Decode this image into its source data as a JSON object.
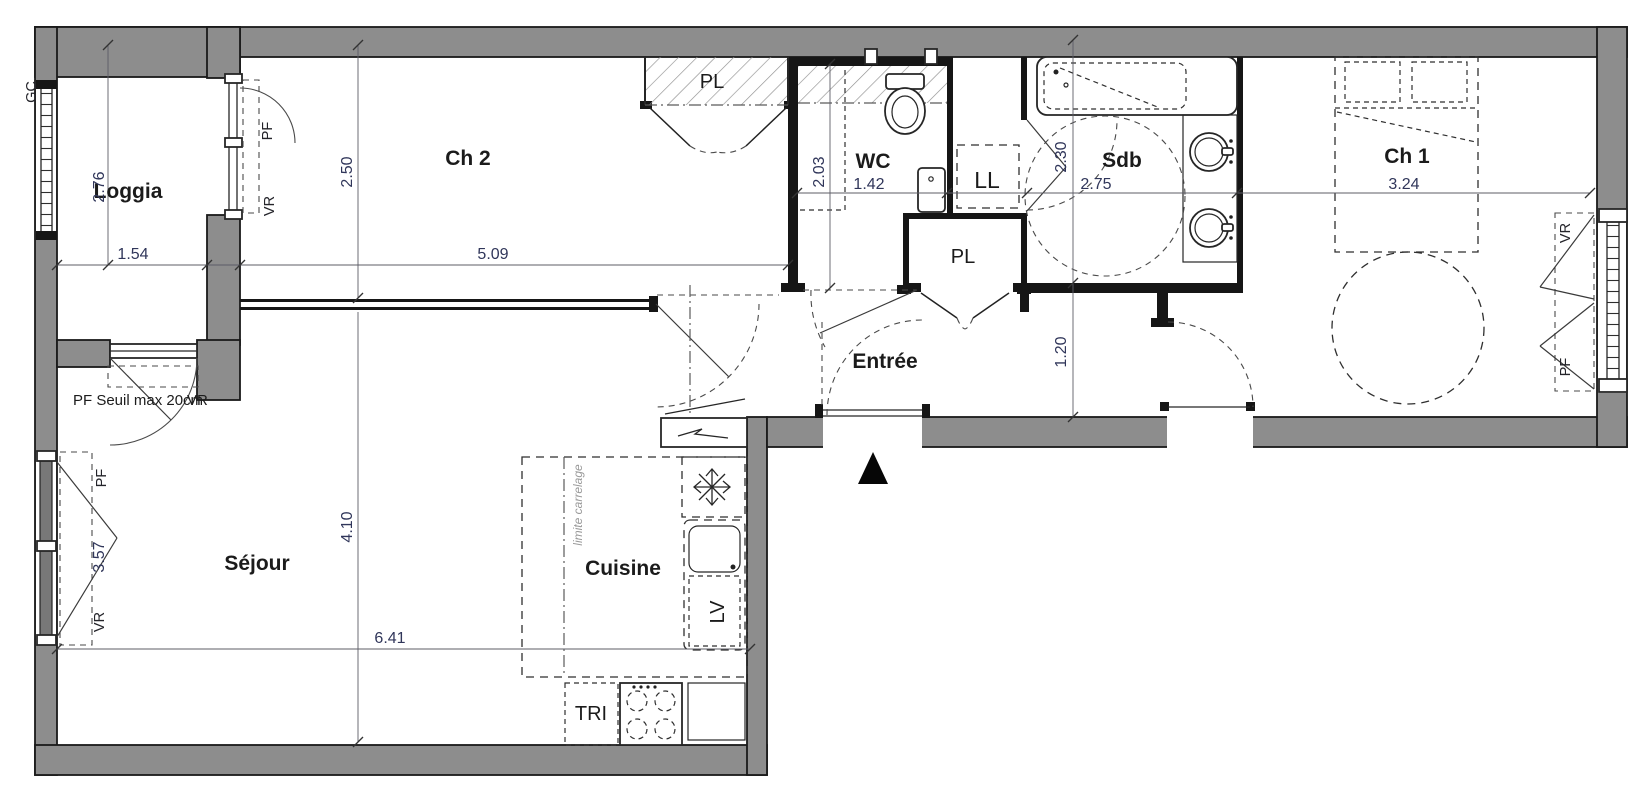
{
  "plan": {
    "type": "floor-plan",
    "rooms": {
      "loggia": {
        "label": "Loggia",
        "dim_h": "2.76",
        "dim_w": "1.54"
      },
      "ch2": {
        "label": "Ch 2",
        "dim_h": "2.50",
        "dim_w": "5.09"
      },
      "sejour": {
        "label": "Séjour",
        "dim_h": "4.10",
        "dim_w": "6.41"
      },
      "cuisine": {
        "label": "Cuisine"
      },
      "entree": {
        "label": "Entrée",
        "dim_hall": "1.20"
      },
      "wc": {
        "label": "WC",
        "dim_h": "2.03",
        "dim_w": "1.42"
      },
      "sdb": {
        "label": "Sdb",
        "dim_h": "2.30",
        "dim_w": "2.75"
      },
      "ch1": {
        "label": "Ch 1",
        "dim_w": "3.24"
      },
      "pl_top": {
        "label": "PL"
      },
      "pl_hall": {
        "label": "PL"
      },
      "ll": {
        "label": "LL"
      },
      "tri": {
        "label": "TRI"
      },
      "lv": {
        "label": "LV"
      }
    },
    "annotations": {
      "gc": "GC",
      "loggia_window_pf": "PF",
      "loggia_window_vr": "VR",
      "loggia_door_note": "PF Seuil max 20cm",
      "loggia_door_vr": "VR",
      "sejour_window_pf": "PF",
      "sejour_window_dim": "3.57",
      "sejour_window_vr": "VR",
      "ch1_window_vr": "VR",
      "ch1_window_pf": "PF",
      "limite_carrelage": "limite carrelage"
    },
    "colors": {
      "wall": "#8d8d8d",
      "wall_dark": "#161616",
      "paper": "#ffffff",
      "dim_text": "#30365a"
    }
  }
}
